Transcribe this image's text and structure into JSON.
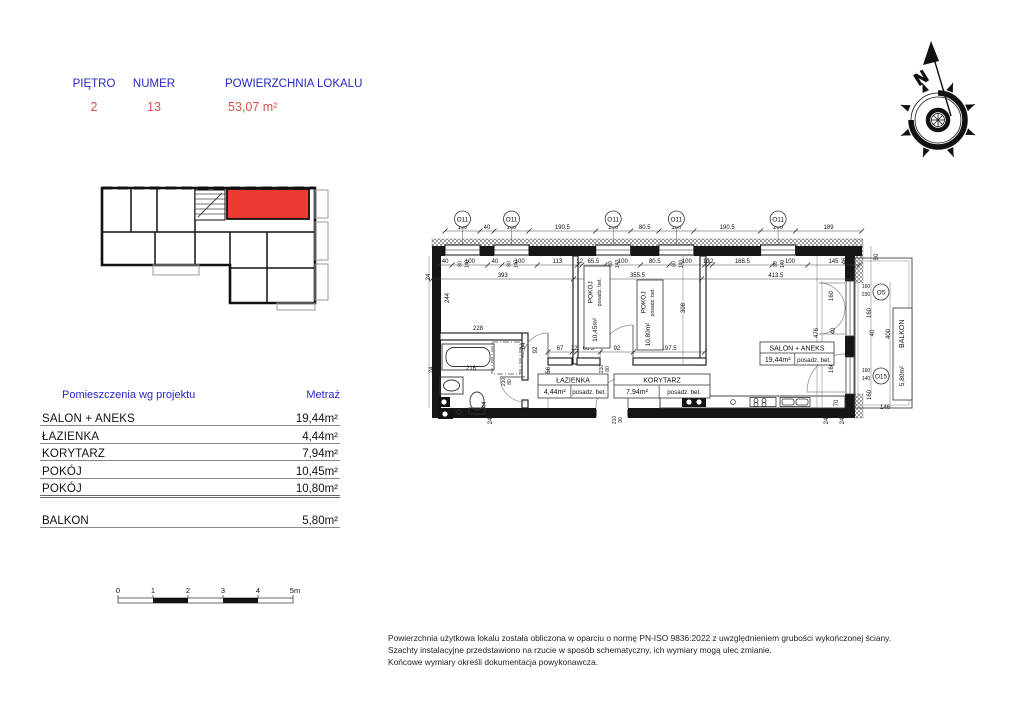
{
  "header": {
    "fields": [
      {
        "label": "PIĘTRO",
        "value": "2"
      },
      {
        "label": "NUMER",
        "value": "13"
      },
      {
        "label": "POWIERZCHNIA LOKALU",
        "value": "53,07 m²"
      }
    ]
  },
  "colors": {
    "accent_blue": "#2626c9",
    "accent_red": "#d9534a",
    "unit_highlight": "#ee3a30"
  },
  "rooms_table": {
    "header": {
      "col1": "Pomieszczenia wg projektu",
      "col2": "Metraż"
    },
    "rows": [
      {
        "name": "SALON + ANEKS",
        "area": "19,44m²"
      },
      {
        "name": "ŁAZIENKA",
        "area": "4,44m²"
      },
      {
        "name": "KORYTARZ",
        "area": "7,94m²"
      },
      {
        "name": "POKÓJ",
        "area": "10,45m²"
      },
      {
        "name": "POKÓJ",
        "area": "10,80m²"
      }
    ],
    "extra_row": {
      "name": "BALKON",
      "area": "5,80m²"
    }
  },
  "scale_bar": {
    "labels": [
      "0",
      "1",
      "2",
      "3",
      "4",
      "5m"
    ]
  },
  "compass": {
    "north_label": "N"
  },
  "footer": {
    "lines": [
      "Powierzchnia użytkowa lokalu została obliczona w oparciu o normę PN-ISO 9836:2022 z uwzględnieniem grubości wykończonej ściany.",
      "Szachty instalacyjne przedstawiono na rzucie w sposób schematyczny, ich wymiary mogą ulec zmianie.",
      "Końcowe wymiary określi dokumentacja powykonawcza."
    ]
  },
  "plan": {
    "dim_chains": [
      {
        "y": 231,
        "x0": 445,
        "s": 0.35,
        "values": [
          "100",
          "40",
          "100",
          "190.5",
          "100",
          "80.5",
          "100",
          "190.5",
          "100",
          "189"
        ]
      },
      {
        "y": 265,
        "x0": 438,
        "s": 0.355,
        "values": [
          "40",
          "100",
          "40",
          "100",
          "113",
          "12",
          "65.5",
          "100",
          "80.5",
          "100",
          "10",
          "12",
          "168.5",
          "100",
          "145"
        ]
      },
      {
        "y": 279,
        "x0": 432,
        "s": 0.36,
        "values": [
          "393",
          "355.5",
          "413.5"
        ]
      },
      {
        "y": 352,
        "x0": 548,
        "s": 0.36,
        "values": [
          "67",
          "12",
          "66.5",
          "92",
          "197.5"
        ]
      }
    ],
    "windows": {
      "top": [
        {
          "label": "O11",
          "x": 462.5
        },
        {
          "label": "O11",
          "x": 511.5
        },
        {
          "label": "O11",
          "x": 613.2
        },
        {
          "label": "O11",
          "x": 676.4
        },
        {
          "label": "O11",
          "x": 778.1
        }
      ],
      "right": [
        {
          "label": "O5",
          "x": 881,
          "y": 292
        },
        {
          "label": "O15",
          "x": 881,
          "y": 376
        }
      ],
      "sill_mark": "80",
      "head_mark": "140"
    },
    "annotations": [
      {
        "t": "24",
        "x": 430,
        "y": 277,
        "r": 1
      },
      {
        "t": "244",
        "x": 449,
        "y": 298,
        "r": 1
      },
      {
        "t": "24",
        "x": 433,
        "y": 370,
        "r": 1
      },
      {
        "t": "24",
        "x": 492,
        "y": 421,
        "r": 1
      },
      {
        "t": "44",
        "x": 486,
        "y": 405,
        "r": 1
      },
      {
        "t": "228",
        "x": 478,
        "y": 330,
        "r": 0
      },
      {
        "t": "216",
        "x": 471,
        "y": 370,
        "r": 0
      },
      {
        "t": "64",
        "x": 525,
        "y": 346,
        "r": 1
      },
      {
        "t": "92",
        "x": 537,
        "y": 350,
        "r": 1
      },
      {
        "t": "210",
        "x": 505,
        "y": 382,
        "r": 1,
        "s": 5
      },
      {
        "t": "80",
        "x": 511,
        "y": 382,
        "r": 1,
        "s": 5
      },
      {
        "t": "156",
        "x": 550,
        "y": 372,
        "r": 1
      },
      {
        "t": "210",
        "x": 603,
        "y": 369,
        "r": 1,
        "s": 5
      },
      {
        "t": "80",
        "x": 609,
        "y": 369,
        "r": 1,
        "s": 5
      },
      {
        "t": "308",
        "x": 685,
        "y": 308,
        "r": 1
      },
      {
        "t": "156",
        "x": 690,
        "y": 392,
        "r": 1
      },
      {
        "t": "100",
        "x": 703,
        "y": 385,
        "r": 1
      },
      {
        "t": "210",
        "x": 616,
        "y": 420,
        "r": 1,
        "s": 5
      },
      {
        "t": "90",
        "x": 622,
        "y": 420,
        "r": 1,
        "s": 5
      },
      {
        "t": "476",
        "x": 818,
        "y": 333,
        "r": 1
      },
      {
        "t": "160",
        "x": 833,
        "y": 296,
        "r": 1
      },
      {
        "t": "40",
        "x": 835,
        "y": 331,
        "r": 1
      },
      {
        "t": "160",
        "x": 833,
        "y": 368,
        "r": 1
      },
      {
        "t": "70",
        "x": 838,
        "y": 403,
        "r": 1
      },
      {
        "t": "24",
        "x": 828,
        "y": 421,
        "r": 1
      },
      {
        "t": "24",
        "x": 844,
        "y": 421,
        "r": 1
      },
      {
        "t": "46",
        "x": 846,
        "y": 261,
        "r": 1
      },
      {
        "t": "90",
        "x": 878,
        "y": 257,
        "r": 1
      },
      {
        "t": "160",
        "x": 866,
        "y": 288,
        "r": 0,
        "s": 5
      },
      {
        "t": "230",
        "x": 866,
        "y": 296,
        "r": 0,
        "s": 5
      },
      {
        "t": "160",
        "x": 871,
        "y": 313,
        "r": 1
      },
      {
        "t": "40",
        "x": 874,
        "y": 333,
        "r": 1
      },
      {
        "t": "400",
        "x": 890,
        "y": 334,
        "r": 1
      },
      {
        "t": "160",
        "x": 866,
        "y": 372,
        "r": 0,
        "s": 5
      },
      {
        "t": "140",
        "x": 866,
        "y": 380,
        "r": 0,
        "s": 5
      },
      {
        "t": "160",
        "x": 871,
        "y": 395,
        "r": 1
      },
      {
        "t": "146",
        "x": 885,
        "y": 409,
        "r": 0
      }
    ],
    "rooms": [
      {
        "name": "POKÓJ",
        "area": "10,45m²",
        "floor": "posadz. bet.",
        "x": 584,
        "y": 266,
        "w": 26,
        "h": 82,
        "rot": 1
      },
      {
        "name": "POKÓJ",
        "area": "10,80m²",
        "floor": "posadz. bet.",
        "x": 637,
        "y": 280,
        "w": 26,
        "h": 70,
        "rot": 1
      },
      {
        "name": "SALON + ANEKS",
        "area": "19,44m²",
        "floor": "posadz. bet.",
        "x": 760,
        "y": 342,
        "w": 74,
        "h": 23,
        "rot": 0
      },
      {
        "name": "ŁAZIENKA",
        "area": "4,44m²",
        "floor": "posadz. bet.",
        "x": 538,
        "y": 374,
        "w": 70,
        "h": 24,
        "rot": 0
      },
      {
        "name": "KORYTARZ",
        "area": "7,94m²",
        "floor": "posadz. bet.",
        "x": 614,
        "y": 374,
        "w": 96,
        "h": 24,
        "rot": 0
      },
      {
        "name": "BALKON",
        "area": "5,80m²",
        "x": 893,
        "y": 308,
        "w": 19,
        "h": 92,
        "rot": 1
      }
    ]
  }
}
